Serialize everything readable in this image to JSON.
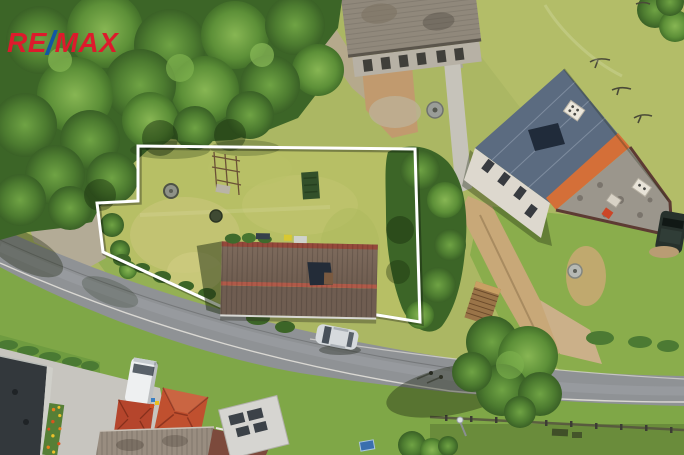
{
  "logo": {
    "re": "RE",
    "slash": "/",
    "max": "MAX",
    "red": "#dd1a2c",
    "blue": "#1156a4"
  },
  "boundary": {
    "color": "#ffffff",
    "points": "138,146 415,149 420,322 377,315 220,306 168,282 103,252 97,203 138,201"
  },
  "palette": {
    "meadow": "#abb763",
    "lawn_green": "#7fa747",
    "field_light": "#b3bd68",
    "tree_green": "#3c6527",
    "road_asphalt": "#8f9295",
    "gravel": "#b3ab96",
    "dirt": "#c8a878",
    "concrete": "#c7c5bf",
    "plot_roof": "#6f5d51",
    "plot_roof_ridge": "#b05a49",
    "big_house_roof_blue": "#5b6b80",
    "big_house_stripe_orange": "#d46f38",
    "big_house_shingle": "#9b968c",
    "red_roof": "#c0502f",
    "van_white": "#eef0f1",
    "car_silver": "#d6dadd"
  },
  "scene": {
    "type": "aerial-drone-photo",
    "subject": "village plot outlined in white with farmhouse, road, trees and neighbouring houses",
    "objects": [
      "tree-canopy",
      "meadow-plot",
      "farmhouse-dark-roof",
      "asphalt-road",
      "gravel-driveway",
      "blue-roof-house",
      "old-building",
      "woodpile",
      "silver-car",
      "white-van",
      "red-hip-roofs",
      "fire-pit",
      "garden-beds"
    ]
  }
}
